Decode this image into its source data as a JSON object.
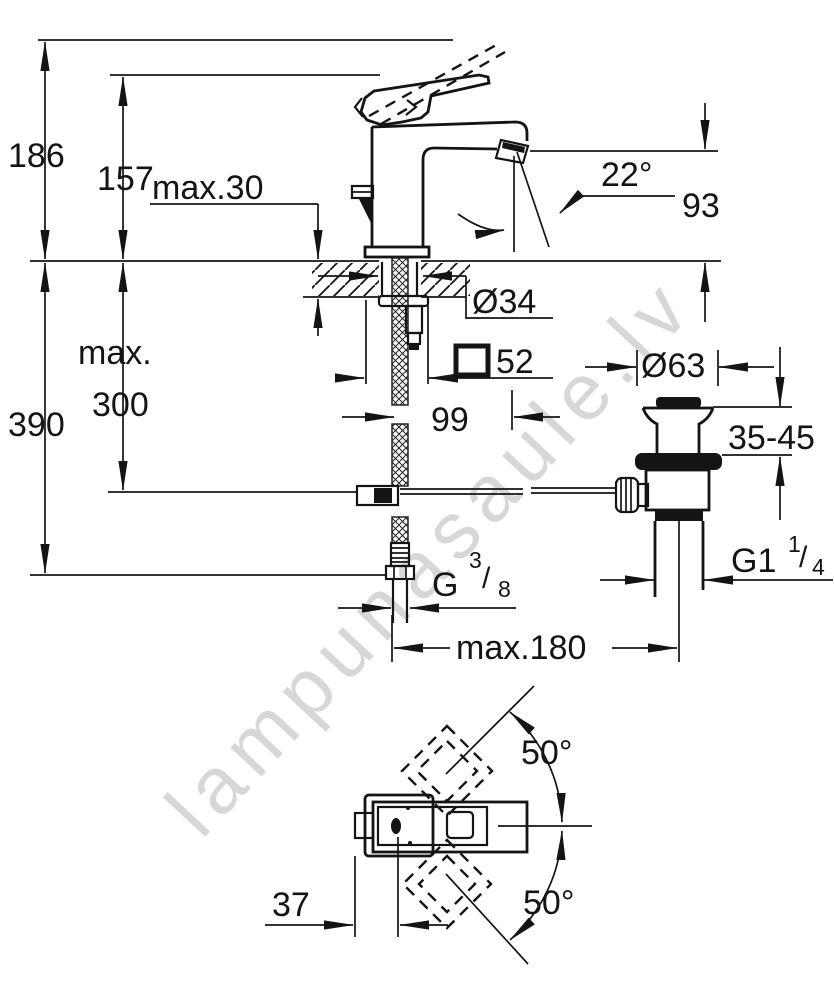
{
  "watermark": {
    "text": "lampunasaule.lv"
  },
  "labels": {
    "total_height": "186",
    "spout_tip_height": "157",
    "deck_thickness_max": "max.30",
    "stream_angle": "22°",
    "spout_height": "93",
    "supply_max_prefix": "max.",
    "supply_max_value": "300",
    "install_depth": "390",
    "hole_diameter": "Ø34",
    "body_width": "52",
    "spout_projection": "99",
    "waste_diameter": "Ø63",
    "waste_deck_range": "35-45",
    "waste_thread_base": "G1",
    "waste_thread_sup": "1",
    "waste_thread_slash": "/",
    "waste_thread_sub": "4",
    "supply_thread_base": "G",
    "supply_thread_sup": "3",
    "supply_thread_slash": "/",
    "supply_thread_sub": "8",
    "rod_reach_max": "max.180",
    "handle_swing_up": "50°",
    "handle_swing_down": "50°",
    "handle_offset": "37"
  }
}
